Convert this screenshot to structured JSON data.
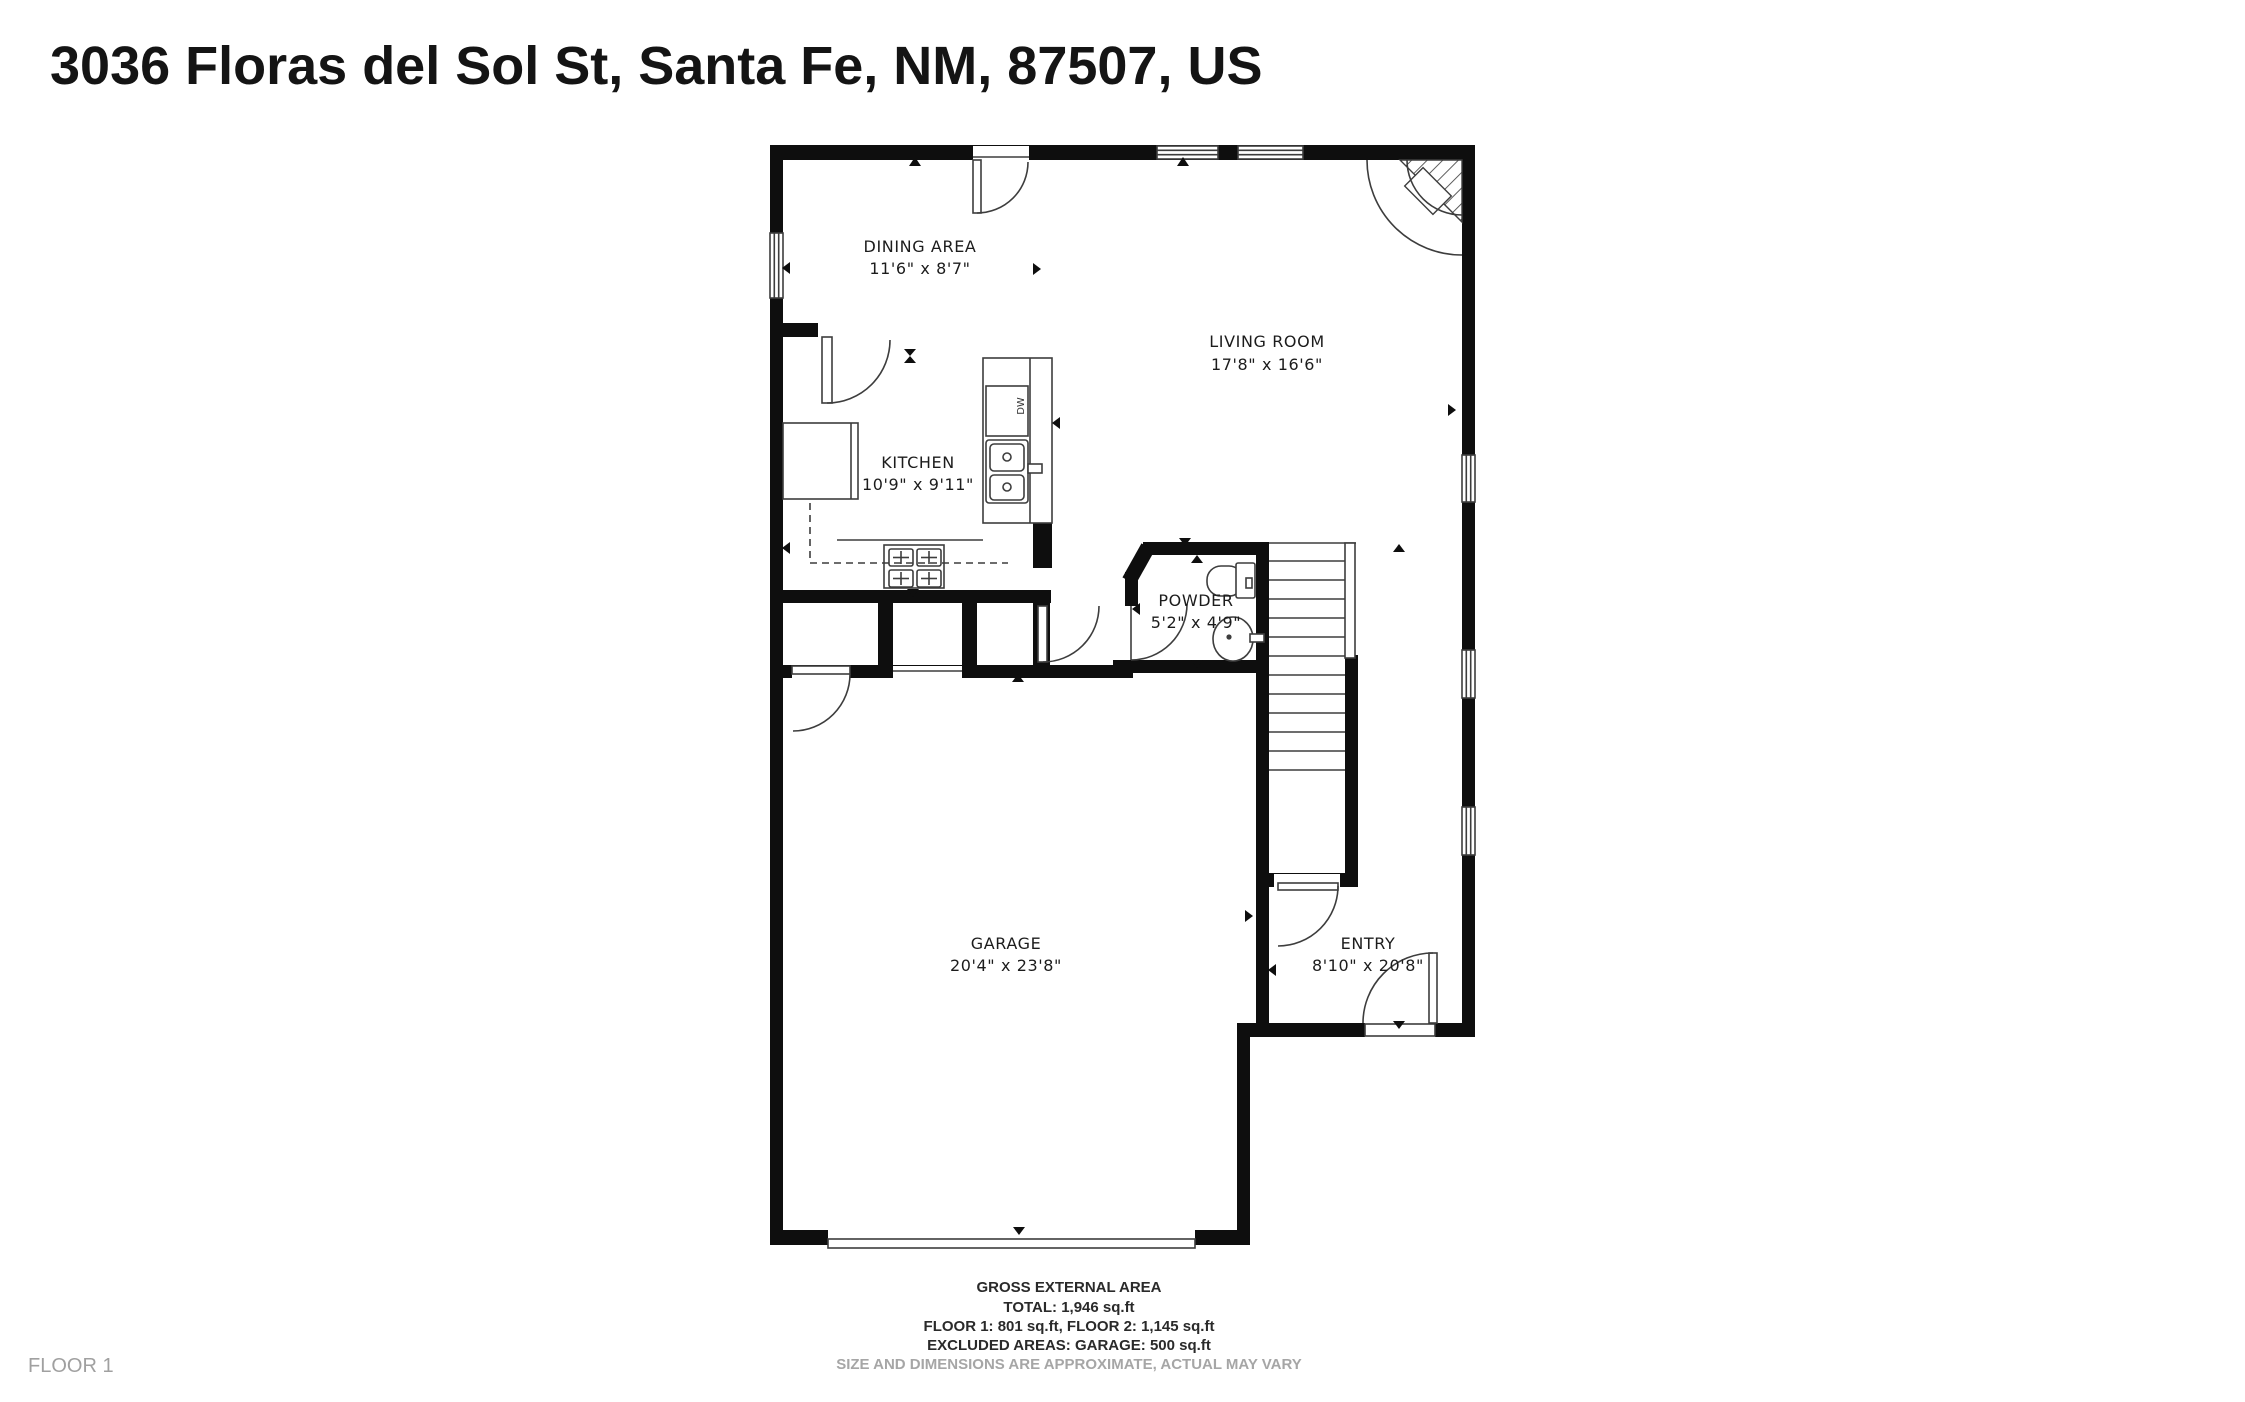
{
  "title": "3036 Floras del Sol St, Santa Fe, NM, 87507, US",
  "floor_label": "FLOOR 1",
  "rooms": {
    "dining": {
      "name": "DINING AREA",
      "dims": "11'6\" x 8'7\""
    },
    "living": {
      "name": "LIVING ROOM",
      "dims": "17'8\" x 16'6\""
    },
    "kitchen": {
      "name": "KITCHEN",
      "dims": "10'9\" x 9'11\""
    },
    "powder": {
      "name": "POWDER",
      "dims": "5'2\" x 4'9\""
    },
    "garage": {
      "name": "GARAGE",
      "dims": "20'4\" x 23'8\""
    },
    "entry": {
      "name": "ENTRY",
      "dims": "8'10\" x 20'8\""
    }
  },
  "fixtures": {
    "dishwasher_label": "DW"
  },
  "footer": {
    "heading": "GROSS EXTERNAL AREA",
    "total": "TOTAL: 1,946 sq.ft",
    "floors": "FLOOR 1: 801 sq.ft, FLOOR 2: 1,145 sq.ft",
    "excluded": "EXCLUDED AREAS: GARAGE: 500 sq.ft",
    "disclaimer": "SIZE AND DIMENSIONS ARE APPROXIMATE, ACTUAL MAY VARY"
  },
  "colors": {
    "wall": "#0e0e0e",
    "line": "#3d3d3d",
    "text": "#1c1c1c",
    "muted": "#a0a0a0"
  }
}
